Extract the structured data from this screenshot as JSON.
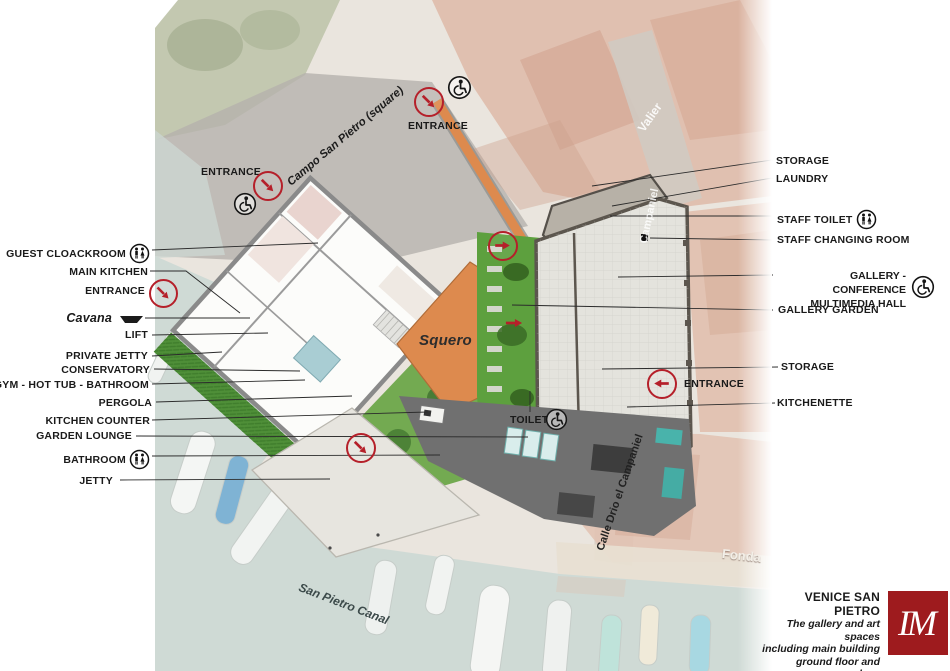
{
  "colors": {
    "accent_red": "#b5202a",
    "logo_red": "#9e1b1e",
    "orange_area": "#dd8a4e",
    "garden_green": "#5da03e",
    "water": "#cfdad5"
  },
  "left_labels": [
    "GUEST CLOACKROOM",
    "MAIN KITCHEN",
    "ENTRANCE",
    "Cavana",
    "LIFT",
    "PRIVATE JETTY",
    "CONSERVATORY",
    "GYM - HOT TUB - BATHROOM",
    "PERGOLA",
    "KITCHEN COUNTER",
    "GARDEN LOUNGE",
    "BATHROOM",
    "JETTY"
  ],
  "right_labels": [
    "STORAGE",
    "LAUNDRY",
    "STAFF TOILET",
    "STAFF CHANGING ROOM",
    "GALLERY - CONFERENCE",
    "MULTIMEDIA HALL",
    "GALLERY GARDEN",
    "STORAGE",
    "ENTRANCE",
    "KITCHENETTE"
  ],
  "entrances": {
    "top": "ENTRANCE",
    "upper_left": "ENTRANCE"
  },
  "plan_labels": {
    "squero": "Squero",
    "toilet": "TOILET"
  },
  "map_labels": {
    "campo": "Campo San Pietro (square)",
    "canal": "San Pietro Canal",
    "valier": "Valier",
    "campaniel": "Campaniel",
    "fonda": "Fonda",
    "calle": "Calle Drio el Campaniel"
  },
  "title_block": {
    "title": "VENICE SAN PIETRO",
    "subtitle_lines": [
      "The gallery and art spaces",
      "including main building",
      "ground floor and gardens"
    ],
    "doc_type": "Floor plan",
    "logo_monogram": "IM"
  }
}
